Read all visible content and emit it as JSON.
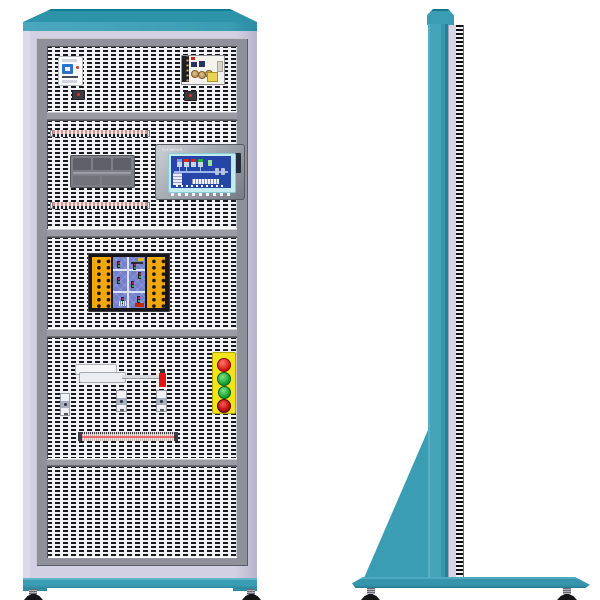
{
  "title": "Electrical training cabinet illustration — front and side elevations",
  "palette": {
    "background": "#ffffff",
    "teal": "#3b9db3",
    "teal_dark": "#26798f",
    "teal_light": "#54aec2",
    "lavender_body": "#d9d5e8",
    "frame_gray": "#90909a",
    "mesh_dash": "#191920",
    "mesh_background": "#f2f2f6",
    "terminal_strip_pink": "#dc9494",
    "board_orange": "#f2a70a",
    "pcb_blue": "#7480cc",
    "hmi_screen_blue": "#2545a8",
    "panel_yellow": "#f1e41a",
    "button_red": "#d81515",
    "button_green": "#17a032",
    "estop_red": "#c01010",
    "foot_black": "#151518"
  },
  "front_view": {
    "hmi": {
      "brand": "SIEMENS"
    },
    "sections": [
      {
        "name": "top-bay",
        "components": [
          "miniature-circuit-breaker",
          "switching-power-supply",
          "fuse-block",
          "fuse-block"
        ]
      },
      {
        "name": "control-bay",
        "components": [
          "terminal-strip",
          "plc-module",
          "hmi-touch-panel",
          "terminal-strip"
        ]
      },
      {
        "name": "trainer-bay",
        "components": [
          "traffic-light-trainer-board"
        ]
      },
      {
        "name": "io-bay",
        "components": [
          "relay-socket",
          "signal-wire",
          "red-indicator-fuse",
          "limit-switch",
          "limit-switch",
          "limit-switch",
          "pushbutton-panel",
          "terminal-strip-long"
        ]
      },
      {
        "name": "empty-bay",
        "components": []
      }
    ],
    "pushbutton_panel": {
      "buttons": [
        "red-indicator",
        "green-indicator",
        "green-indicator",
        "emergency-stop"
      ]
    },
    "feet_count": 2
  },
  "side_view": {
    "parts": [
      "cap",
      "column",
      "rear-hinge-strip",
      "support-gusset",
      "base-plate"
    ],
    "feet_count": 2
  }
}
